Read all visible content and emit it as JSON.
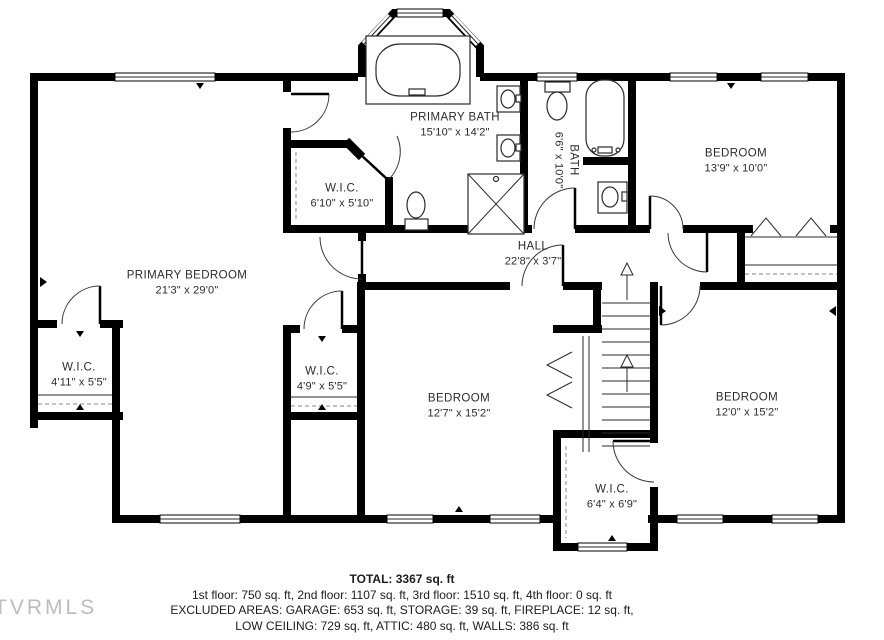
{
  "plan": {
    "rooms": [
      {
        "name": "PRIMARY BATH",
        "dims": "15'10\" x 14'2\""
      },
      {
        "name": "W.I.C.",
        "dims": "6'10\" x 5'10\""
      },
      {
        "name": "BATH",
        "dims": "6'6\" x 10'0\""
      },
      {
        "name": "BEDROOM",
        "dims": "13'9\" x 10'0\""
      },
      {
        "name": "HALL",
        "dims": "22'8\" x 3'7\""
      },
      {
        "name": "PRIMARY BEDROOM",
        "dims": "21'3\" x 29'0\""
      },
      {
        "name": "W.I.C.",
        "dims": "4'11\" x 5'5\""
      },
      {
        "name": "W.I.C.",
        "dims": "4'9\" x 5'5\""
      },
      {
        "name": "BEDROOM",
        "dims": "12'7\" x 15'2\""
      },
      {
        "name": "BEDROOM",
        "dims": "12'0\" x 15'2\""
      },
      {
        "name": "W.I.C.",
        "dims": "6'4\" x 6'9\""
      }
    ]
  },
  "footer": {
    "total": "TOTAL: 3367 sq. ft",
    "floors": "1st floor: 750 sq. ft, 2nd floor: 1107 sq. ft, 3rd floor: 1510 sq. ft, 4th floor: 0 sq. ft",
    "excluded": "EXCLUDED AREAS: GARAGE: 653 sq. ft, STORAGE: 39 sq. ft, FIREPLACE: 12 sq. ft,",
    "low_ceiling": "LOW CEILING: 729 sq. ft, ATTIC: 480 sq. ft, WALLS: 386 sq. ft"
  },
  "watermark": "TVRMLS",
  "colors": {
    "wall": "#000000",
    "fixture_line": "#2a2a2a",
    "watermark": "#bcbcbc"
  }
}
